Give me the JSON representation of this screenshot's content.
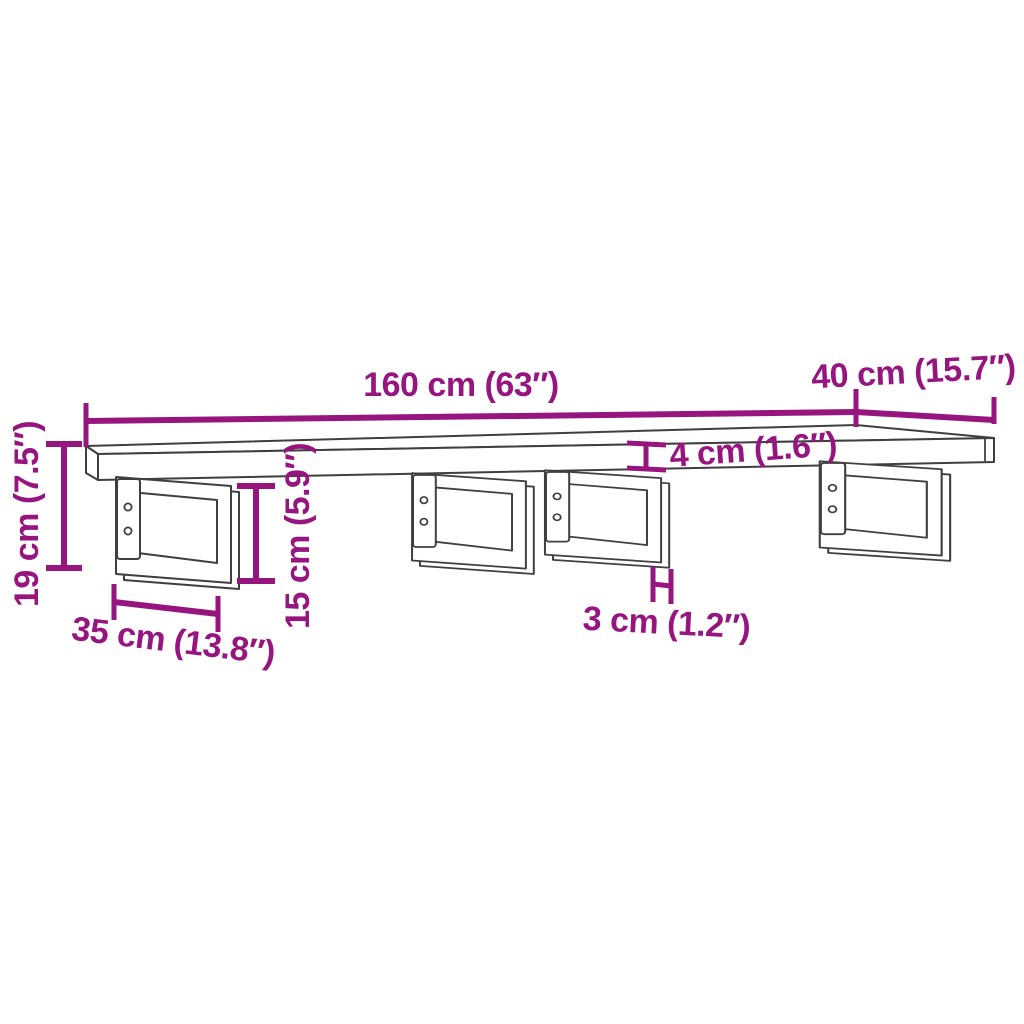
{
  "diagram": {
    "subject": "wall-shelf-with-steel-brackets-dimension-drawing",
    "colors": {
      "dimension_accent": "#97157f",
      "drawing_outline": "#3f3f3f",
      "background": "#ffffff"
    },
    "labels": {
      "length": "160 cm (63″)",
      "depth": "40 cm (15.7″)",
      "overall_height": "19 cm (7.5″)",
      "bracket_height": "15 cm (5.9″)",
      "board_thickness": "4 cm (1.6″)",
      "bracket_bar_width": "3 cm (1.2″)",
      "bracket_depth": "35 cm (13.8″)"
    }
  }
}
